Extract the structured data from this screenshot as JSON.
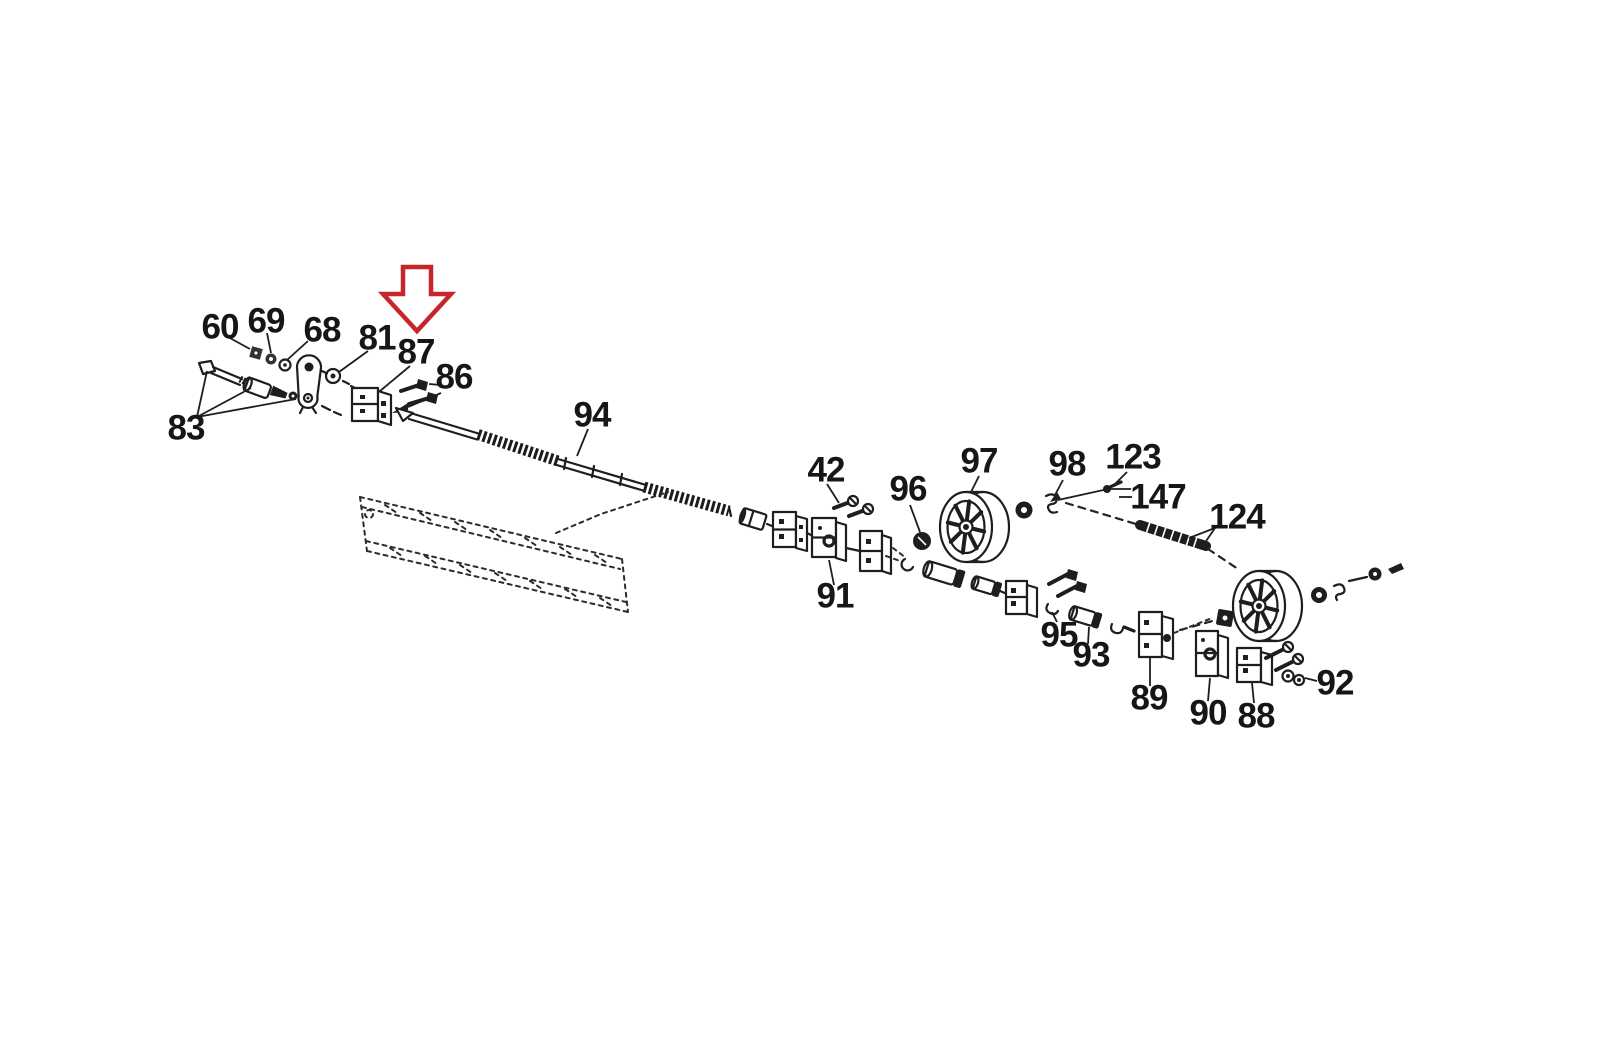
{
  "page": {
    "background": "#ffffff",
    "kind": "exploded-parts-diagram"
  },
  "diagram": {
    "ink_color": "#1e1e1e",
    "label_font_size": 35,
    "highlight_arrow": {
      "name": "red-highlight-arrow",
      "color": "#c5262c",
      "fill": "#ffffff",
      "points": "403,267 431,267 431,294 451,294 417,331 383,294 403,294",
      "points_to_part": "87"
    },
    "labels": [
      {
        "id": "60",
        "text": "60",
        "x": 220,
        "y": 327
      },
      {
        "id": "69",
        "text": "69",
        "x": 266,
        "y": 321
      },
      {
        "id": "68",
        "text": "68",
        "x": 322,
        "y": 330
      },
      {
        "id": "81",
        "text": "81",
        "x": 377,
        "y": 338
      },
      {
        "id": "87",
        "text": "87",
        "x": 416,
        "y": 352
      },
      {
        "id": "86",
        "text": "86",
        "x": 454,
        "y": 377
      },
      {
        "id": "83",
        "text": "83",
        "x": 186,
        "y": 428
      },
      {
        "id": "94",
        "text": "94",
        "x": 592,
        "y": 415
      },
      {
        "id": "42",
        "text": "42",
        "x": 826,
        "y": 470
      },
      {
        "id": "91",
        "text": "91",
        "x": 835,
        "y": 596
      },
      {
        "id": "96",
        "text": "96",
        "x": 908,
        "y": 489
      },
      {
        "id": "97",
        "text": "97",
        "x": 979,
        "y": 461
      },
      {
        "id": "98",
        "text": "98",
        "x": 1067,
        "y": 464
      },
      {
        "id": "123",
        "text": "123",
        "x": 1133,
        "y": 457
      },
      {
        "id": "147",
        "text": "147",
        "x": 1158,
        "y": 497
      },
      {
        "id": "124",
        "text": "124",
        "x": 1237,
        "y": 517
      },
      {
        "id": "95",
        "text": "95",
        "x": 1059,
        "y": 635
      },
      {
        "id": "93",
        "text": "93",
        "x": 1091,
        "y": 655
      },
      {
        "id": "89",
        "text": "89",
        "x": 1149,
        "y": 698
      },
      {
        "id": "90",
        "text": "90",
        "x": 1208,
        "y": 713
      },
      {
        "id": "88",
        "text": "88",
        "x": 1256,
        "y": 716
      },
      {
        "id": "92",
        "text": "92",
        "x": 1335,
        "y": 683
      }
    ],
    "leaders": [
      {
        "for": "60",
        "x1": 228,
        "y1": 337,
        "x2": 250,
        "y2": 349
      },
      {
        "for": "69",
        "x1": 267,
        "y1": 333,
        "x2": 271,
        "y2": 353
      },
      {
        "for": "68",
        "x1": 308,
        "y1": 341,
        "x2": 287,
        "y2": 360
      },
      {
        "for": "81",
        "x1": 368,
        "y1": 351,
        "x2": 339,
        "y2": 372
      },
      {
        "for": "87",
        "x1": 410,
        "y1": 366,
        "x2": 380,
        "y2": 391
      },
      {
        "for": "86",
        "x1": 441,
        "y1": 385,
        "x2": 429,
        "y2": 384
      },
      {
        "for": "86",
        "x1": 441,
        "y1": 393,
        "x2": 408,
        "y2": 407
      },
      {
        "for": "83",
        "x1": 197,
        "y1": 417,
        "x2": 207,
        "y2": 371
      },
      {
        "for": "83",
        "x1": 197,
        "y1": 417,
        "x2": 251,
        "y2": 388
      },
      {
        "for": "83",
        "x1": 197,
        "y1": 417,
        "x2": 296,
        "y2": 399
      },
      {
        "for": "94",
        "x1": 588,
        "y1": 429,
        "x2": 577,
        "y2": 456
      },
      {
        "for": "42",
        "x1": 827,
        "y1": 484,
        "x2": 839,
        "y2": 503
      },
      {
        "for": "91",
        "x1": 834,
        "y1": 585,
        "x2": 829,
        "y2": 560
      },
      {
        "for": "96",
        "x1": 910,
        "y1": 505,
        "x2": 920,
        "y2": 532
      },
      {
        "for": "97",
        "x1": 979,
        "y1": 476,
        "x2": 971,
        "y2": 492
      },
      {
        "for": "98",
        "x1": 1063,
        "y1": 480,
        "x2": 1055,
        "y2": 495
      },
      {
        "for": "123",
        "x1": 1127,
        "y1": 472,
        "x2": 1114,
        "y2": 485
      },
      {
        "for": "147",
        "x1": 1132,
        "y1": 497,
        "x2": 1119,
        "y2": 497
      },
      {
        "for": "124",
        "x1": 1215,
        "y1": 528,
        "x2": 1189,
        "y2": 538
      },
      {
        "for": "124",
        "x1": 1215,
        "y1": 528,
        "x2": 1202,
        "y2": 547
      },
      {
        "for": "95",
        "x1": 1057,
        "y1": 622,
        "x2": 1052,
        "y2": 612
      },
      {
        "for": "93",
        "x1": 1088,
        "y1": 644,
        "x2": 1089,
        "y2": 627
      },
      {
        "for": "89",
        "x1": 1150,
        "y1": 686,
        "x2": 1150,
        "y2": 658
      },
      {
        "for": "90",
        "x1": 1208,
        "y1": 701,
        "x2": 1210,
        "y2": 678
      },
      {
        "for": "88",
        "x1": 1254,
        "y1": 703,
        "x2": 1252,
        "y2": 683
      },
      {
        "for": "92",
        "x1": 1317,
        "y1": 681,
        "x2": 1305,
        "y2": 678
      }
    ]
  }
}
